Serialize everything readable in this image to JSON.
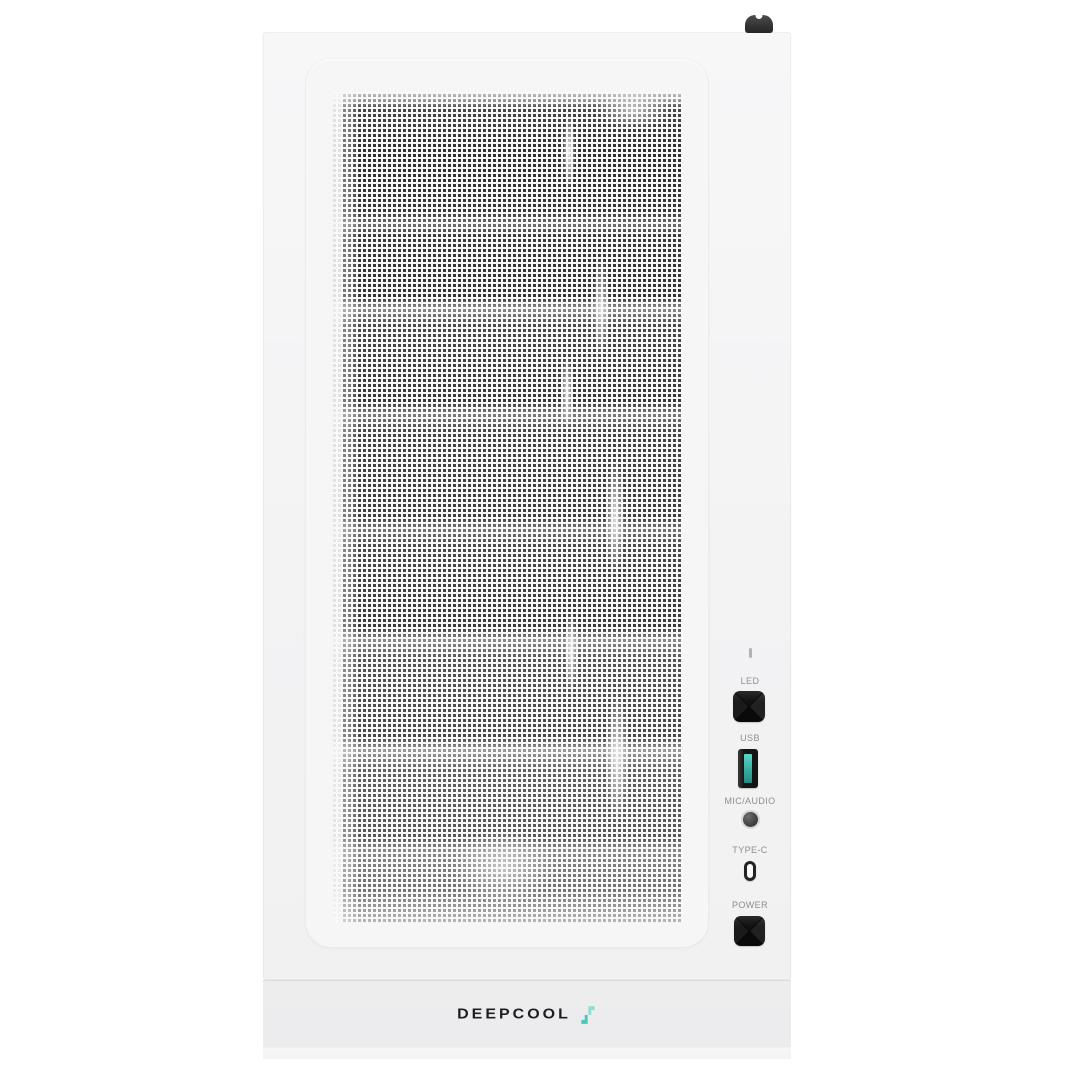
{
  "product": {
    "type": "pc-case-front-view",
    "brand_wordmark": "DEEPCOOL"
  },
  "io_panel": {
    "ports": [
      {
        "label": "LED",
        "type": "led-button"
      },
      {
        "label": "USB",
        "type": "usb-a-port"
      },
      {
        "label": "MIC/AUDIO",
        "type": "audio-jack"
      },
      {
        "label": "TYPE-C",
        "type": "usb-c-port"
      },
      {
        "label": "POWER",
        "type": "power-button"
      }
    ],
    "indicator_icon": "indicator-tick"
  },
  "icons": {
    "top_knob": "latch-knob",
    "logo_glyph": "deepcool-glyph"
  },
  "colors": {
    "background": "#ffffff",
    "case_body": "#f3f3f4",
    "bottom_band": "#ececee",
    "mesh_dark": "#343434",
    "button_black": "#141414",
    "usb_tongue_teal": "#3ab5a8",
    "logo_teal": "#63d2c6",
    "label_gray": "#8e8e90",
    "wordmark_black": "#1f1f1f"
  }
}
